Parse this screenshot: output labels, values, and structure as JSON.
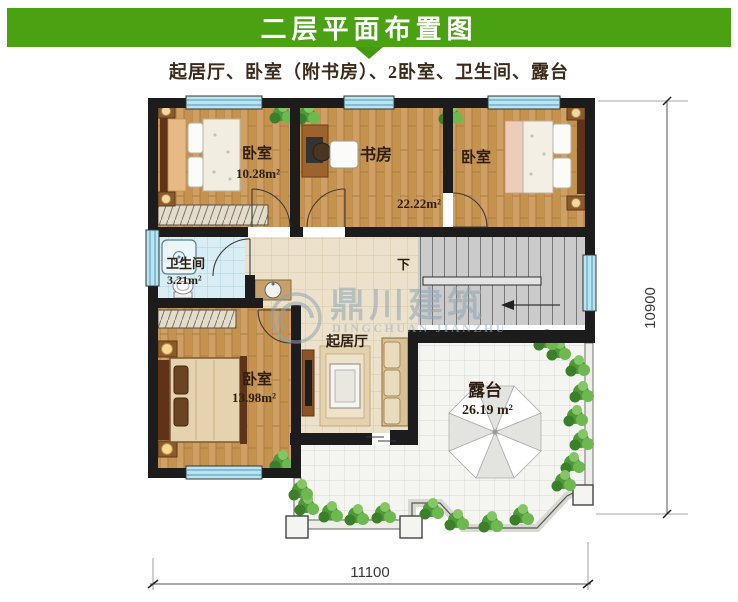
{
  "header": {
    "title": "二层平面布置图",
    "subtitle": "起居厅、卧室（附书房）、2卧室、卫生间、露台"
  },
  "colors": {
    "header_green": "#4aa212",
    "arrow_green": "#429a10",
    "wall_black": "#1c1c1c",
    "window_blue": "#b9e4f1",
    "wood_floor": "#cf9f63",
    "bath_tile": "#d9edf4",
    "terrace_tile": "#f4f4f1",
    "label_text": "#2e1f12"
  },
  "plan": {
    "rooms": {
      "bedroom_top_left": {
        "name": "卧室",
        "area": "10.28m²"
      },
      "study": {
        "name": "书房",
        "area": "22.22m²"
      },
      "bedroom_top_right": {
        "name": "卧室"
      },
      "bathroom": {
        "name": "卫生间",
        "area": "3.21m²"
      },
      "living_room": {
        "name": "起居厅"
      },
      "bedroom_bottom_left": {
        "name": "卧室",
        "area": "13.98m²"
      },
      "terrace": {
        "name": "露台",
        "area": "26.19 m²"
      },
      "stairs": {
        "down_label": "下"
      }
    },
    "dimensions": {
      "width": "11100",
      "height": "10900"
    }
  },
  "watermark": {
    "name": "鼎川建筑",
    "latin": "DINGCHUAN JIANZHU"
  }
}
